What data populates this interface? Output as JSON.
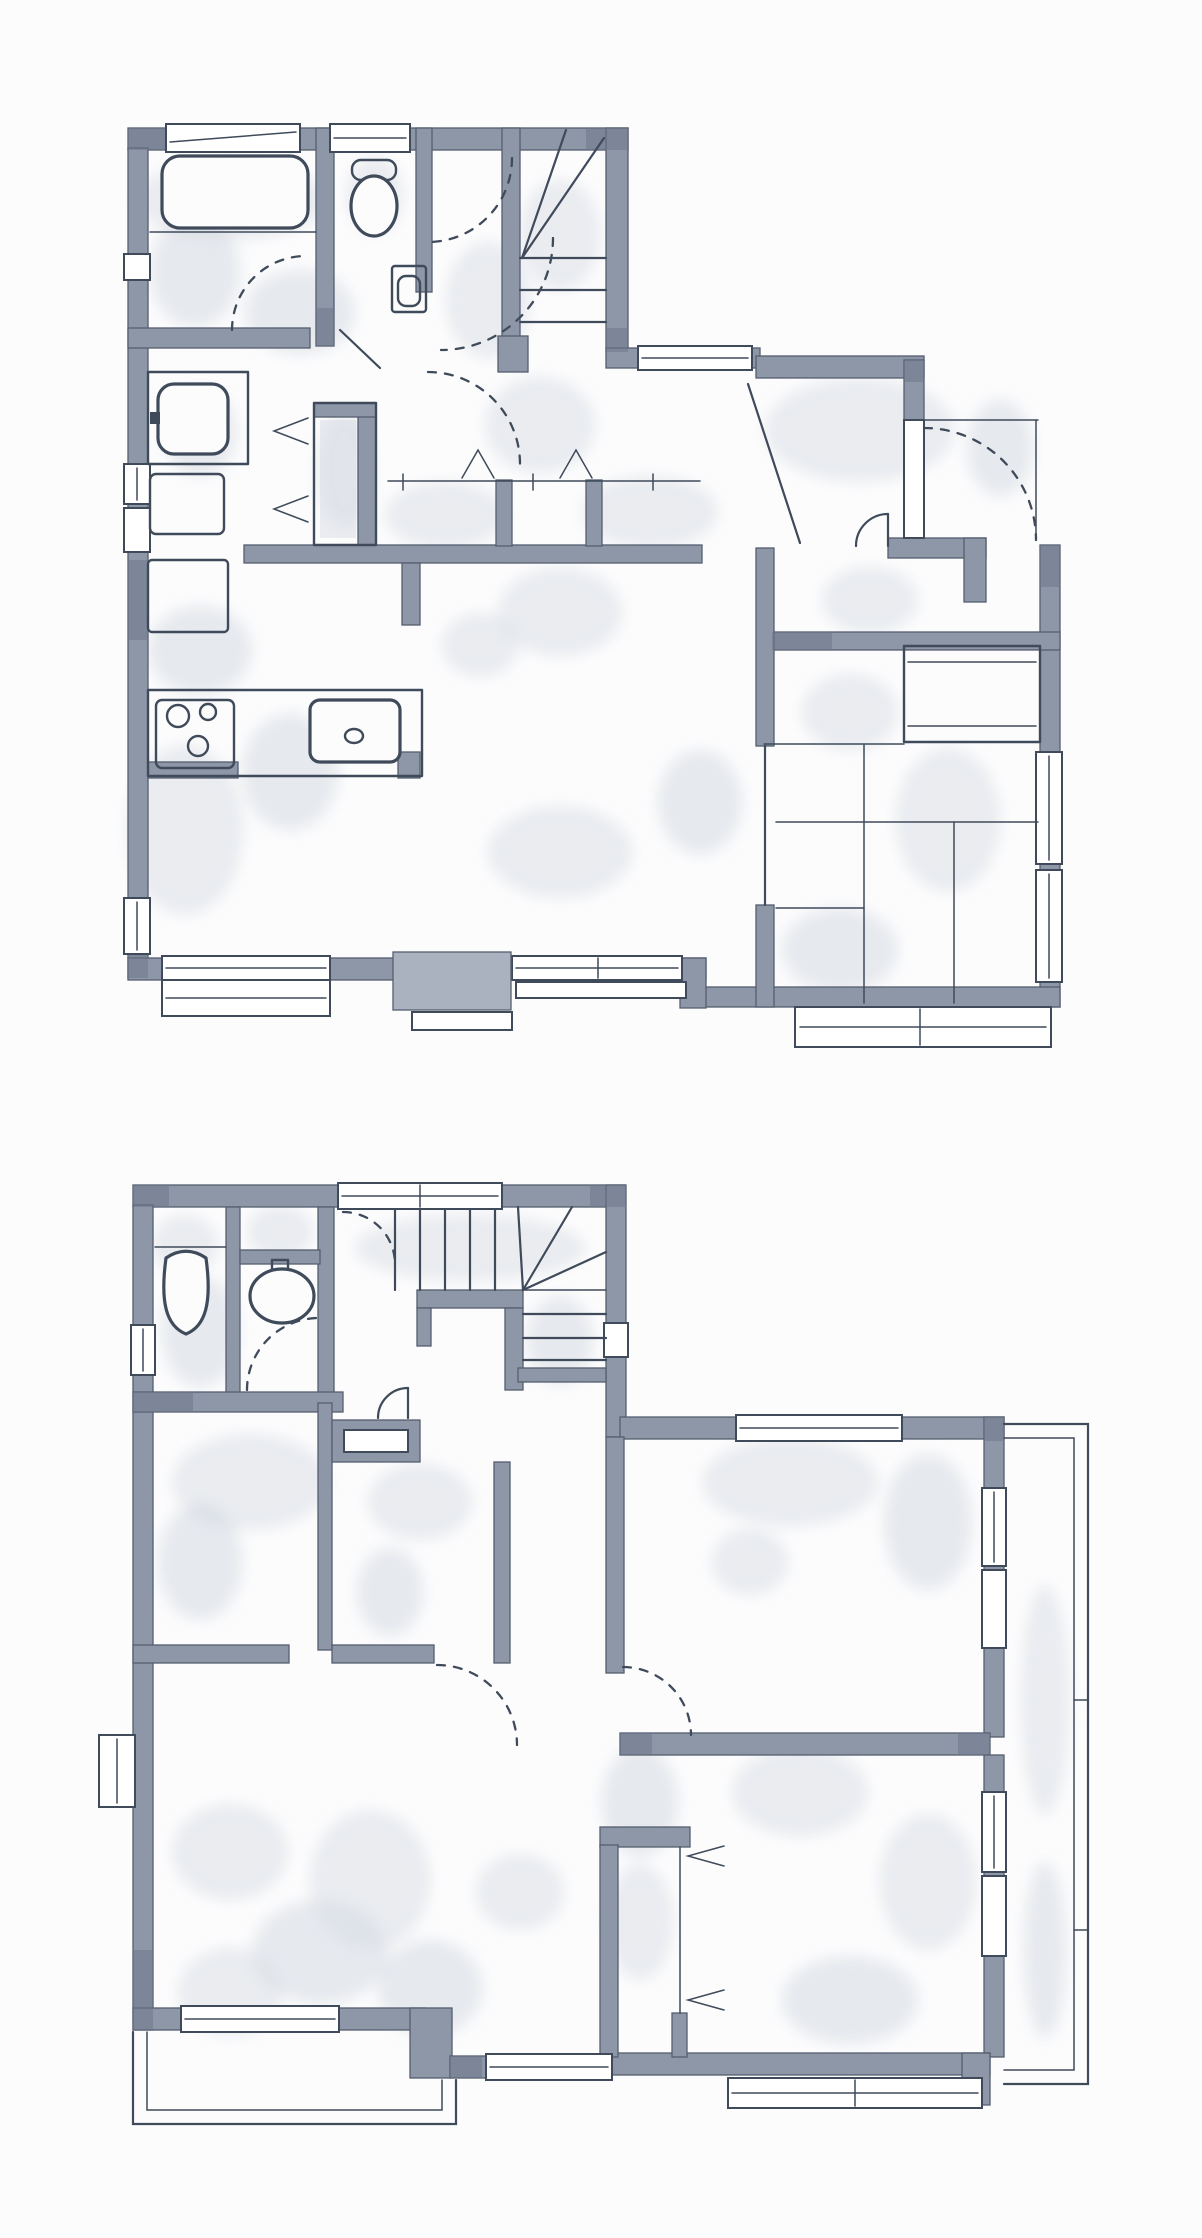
{
  "document": {
    "kind": "hand-drawn architectural floor plan, watercolor ink style",
    "visible_text": "none",
    "plans_count": 2
  },
  "palette": {
    "paper": "#fcfcfd",
    "wall": "#8e97a7",
    "wall_dark": "#6c7689",
    "wall_light": "#aab2c0",
    "wall_edge": "#545e6f",
    "ink": "#3f4a5a",
    "wash": "#d8dce3",
    "wash_dark": "#c9cfd9",
    "window": "#ffffff"
  },
  "floors": [
    {
      "id": "upper-plan",
      "position": "top of page",
      "features": [
        "bathtub",
        "toilet",
        "hand-basin",
        "bathroom-vanity",
        "washing-machine",
        "refrigerator",
        "tall-cabinet",
        "kitchen-counter",
        "cooktop-3-burners",
        "kitchen-sink",
        "winder-staircase",
        "entry-door-swing",
        "sliding-partition",
        "tatami-room-6-mats",
        "oshiire-closet",
        "window-bays",
        "door-swing-arcs",
        "chevron-door-marks"
      ]
    },
    {
      "id": "lower-plan",
      "position": "bottom of page",
      "features": [
        "toilet",
        "wash-basin",
        "winder-staircase",
        "stair-railing",
        "two-small-rooms",
        "closet-with-swing-door",
        "large-bedroom",
        "second-bedroom",
        "bifold-closet",
        "right-balcony",
        "left-balcony",
        "bay-window",
        "window-bays",
        "door-swing-arcs"
      ]
    }
  ]
}
